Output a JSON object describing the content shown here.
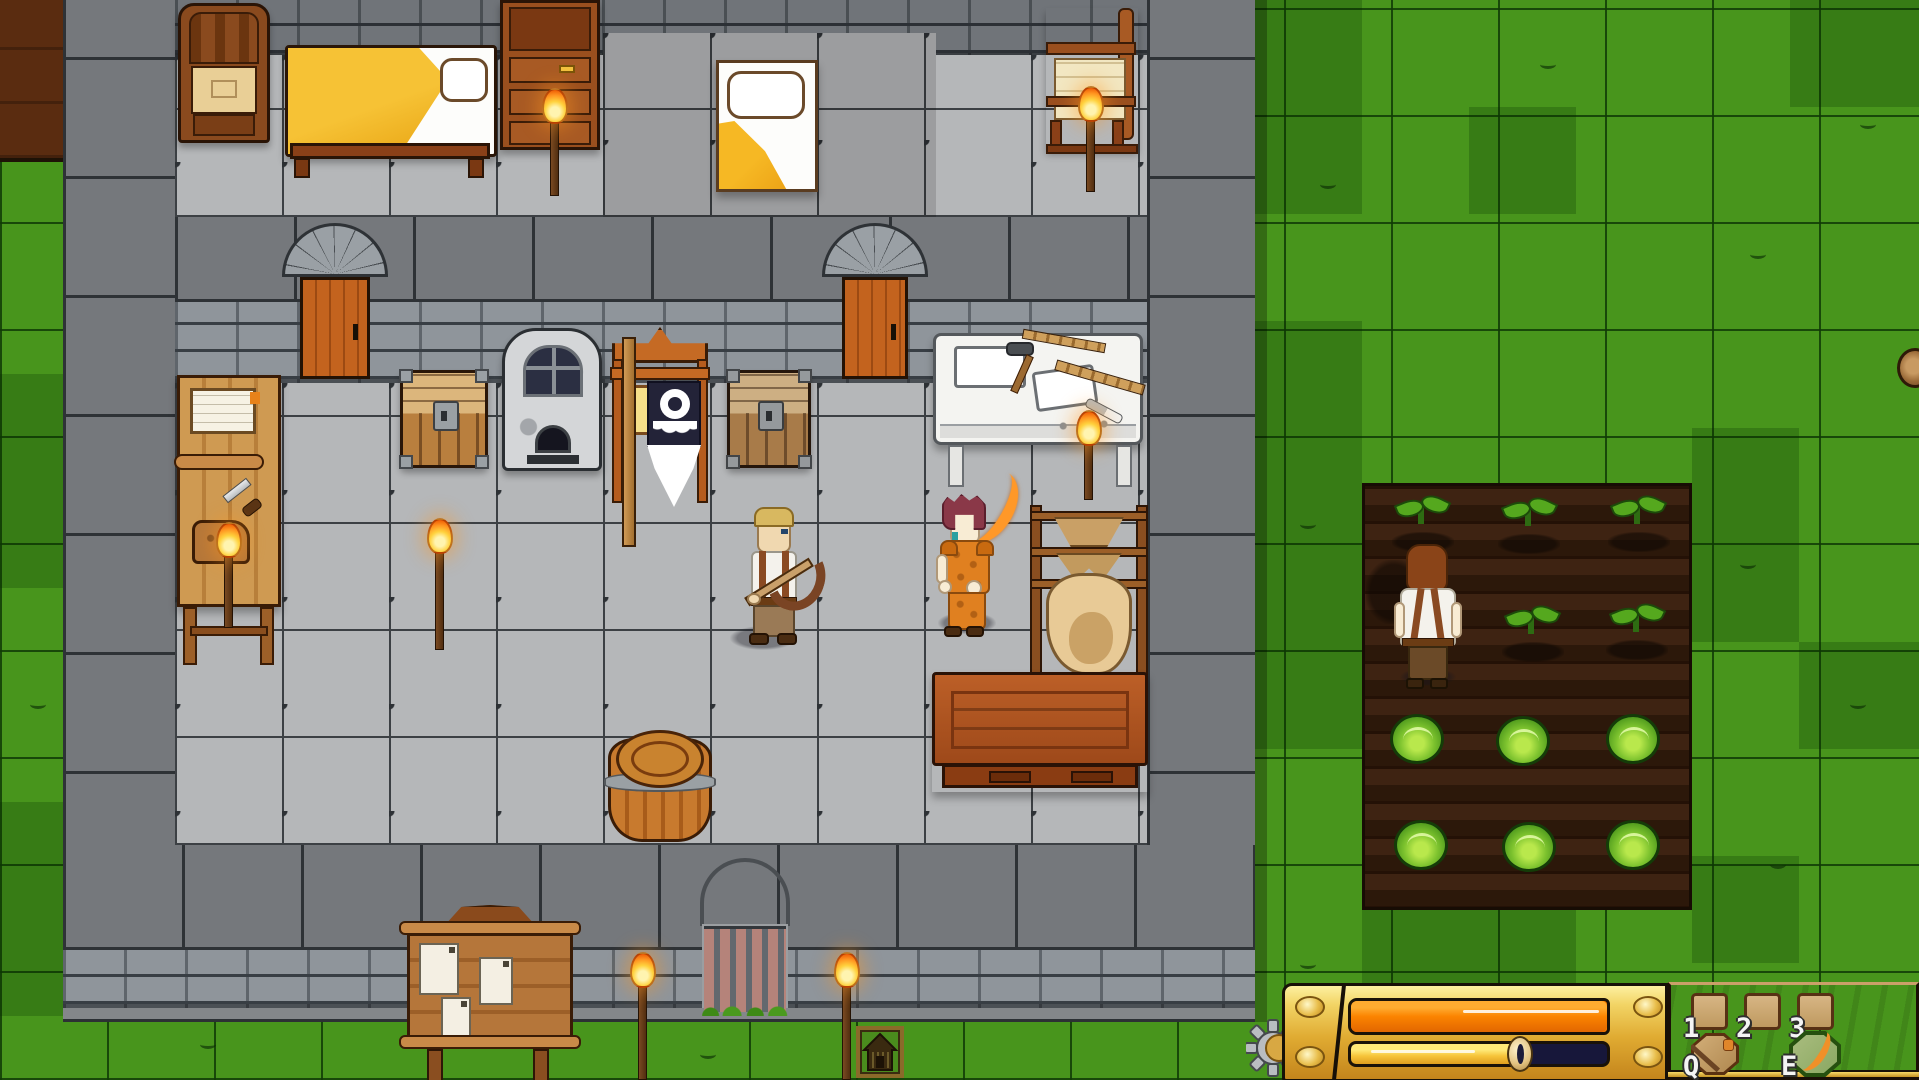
{
  "hud": {
    "gear_icon": "gear-icon",
    "bars": {
      "energy_bar": {
        "fill_percent": 100,
        "fill_color": "#ff8200"
      },
      "progress_bar": {
        "fill_percent": 70,
        "fill_color": "#f6c43a",
        "empty_color": "#17173a",
        "marker": "seed-marker-icon"
      }
    },
    "hotbar": {
      "slots": [
        {
          "key": "1",
          "item": ""
        },
        {
          "key": "2",
          "item": ""
        },
        {
          "key": "3",
          "item": ""
        }
      ],
      "quick_slots": [
        {
          "key": "Q",
          "item": "wooden-shield-tool-icon"
        },
        {
          "key": "E",
          "item": "green-buckler-scimitar-icon"
        }
      ]
    },
    "colors": {
      "panel_gold": "#e8bc42",
      "panel_wood": "#7c3f1c"
    }
  },
  "scene": {
    "characters": [
      {
        "name": "blond-villager",
        "holding": "crossbow"
      },
      {
        "name": "red-haired-warrior",
        "holding": "orange-scimitar"
      },
      {
        "name": "farmer",
        "location": "crop-field"
      }
    ],
    "objects": [
      "throne-chair",
      "yellow-bed",
      "dresser",
      "white-bed",
      "weaving-loom",
      "plank-door",
      "plank-door",
      "guild-banner-gear-emblem",
      "stone-furnace",
      "wooden-chest",
      "wooden-chest",
      "bakers-table",
      "stonemason-table",
      "tanning-rack",
      "work-table",
      "barrel",
      "notice-board",
      "portcullis-gate",
      "house-sign",
      "torches",
      "tree-stump"
    ],
    "crops": {
      "seedlings": 5,
      "cabbages": 6
    },
    "colors": {
      "grass": "#48951c",
      "soil": "#37200f",
      "stone_floor": "#b5b7b9",
      "stone_wall": "#75787c"
    }
  }
}
